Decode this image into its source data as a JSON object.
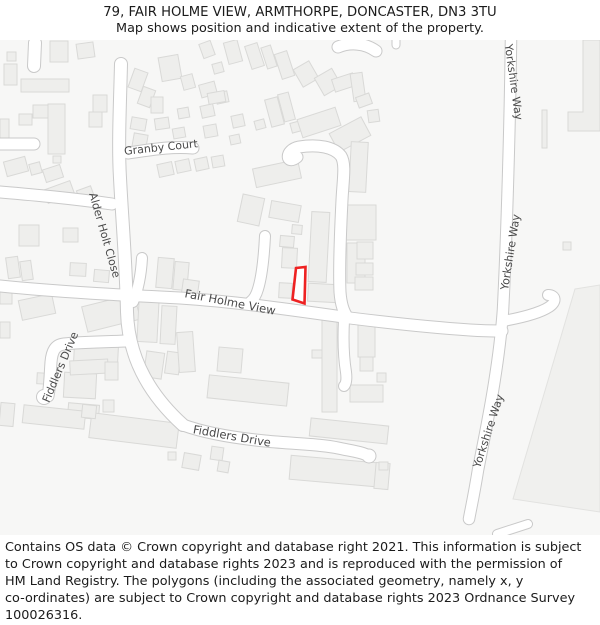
{
  "header": {
    "title": "79, FAIR HOLME VIEW, ARMTHORPE, DONCASTER, DN3 3TU",
    "subtitle": "Map shows position and indicative extent of the property."
  },
  "map": {
    "streets": {
      "granby_court": "Granby Court",
      "alder_holt_close": "Alder Holt Close",
      "fair_holme_view": "Fair Holme View",
      "fiddlers_drive": "Fiddlers Drive",
      "yorkshire_way": "Yorkshire Way"
    },
    "property": {
      "outline_points": "296,268 305.5,267 304.5,303.5 292.5,299.5"
    }
  },
  "footer": {
    "lines": [
      "Contains OS data © Crown copyright and database right 2021. This information is subject",
      "to Crown copyright and database rights 2023 and is reproduced with the permission of",
      "HM Land Registry. The polygons (including the associated geometry, namely x, y",
      "co-ordinates) are subject to Crown copyright and database rights 2023 Ordnance Survey",
      "100026316."
    ]
  },
  "colors": {
    "map_background": "#f7f7f6",
    "building_fill": "#eeeeec",
    "building_stroke": "#d9d9d7",
    "field_fill": "#f0f0ee",
    "field_stroke": "#e2e2e0",
    "road_fill": "#ffffff",
    "road_casing": "#c9c9c9",
    "street_label": "#4a4a4a",
    "property_outline": "#ee2222",
    "text": "#1b1b1b"
  }
}
